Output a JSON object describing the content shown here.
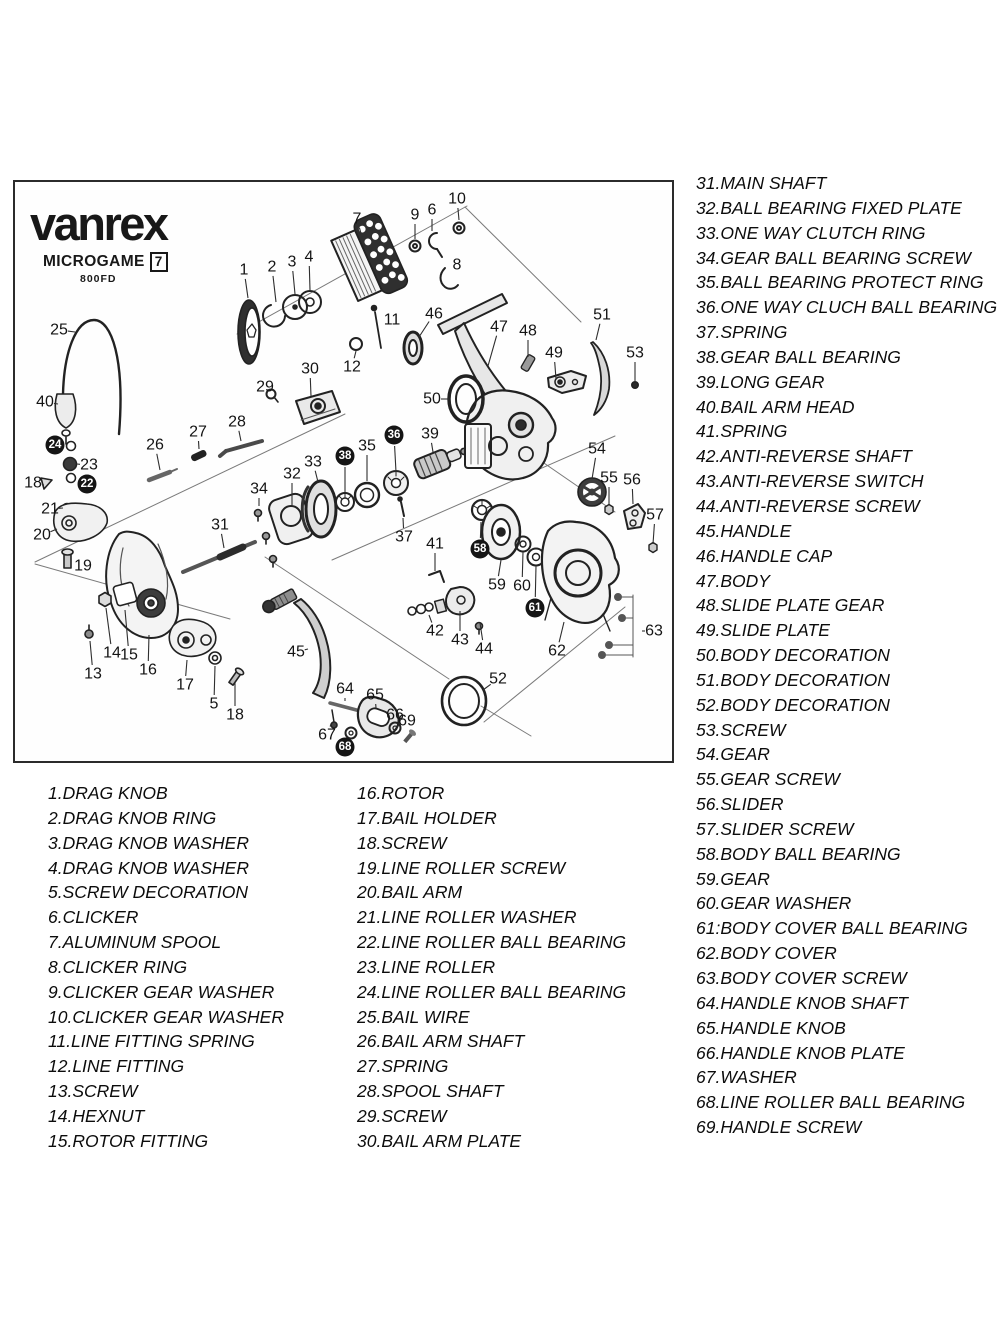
{
  "brand": {
    "logo": "vanrex",
    "series": "MICROGAME",
    "series_code": "7",
    "model": "800FD"
  },
  "parts_list_left": [
    "1.DRAG KNOB",
    "2.DRAG KNOB RING",
    "3.DRAG KNOB WASHER",
    "4.DRAG KNOB WASHER",
    "5.SCREW DECORATION",
    "6.CLICKER",
    "7.ALUMINUM SPOOL",
    "8.CLICKER RING",
    "9.CLICKER GEAR WASHER",
    "10.CLICKER GEAR WASHER",
    "11.LINE FITTING SPRING",
    "12.LINE FITTING",
    "13.SCREW",
    "14.HEXNUT",
    "15.ROTOR FITTING"
  ],
  "parts_list_middle": [
    "16.ROTOR",
    "17.BAIL HOLDER",
    "18.SCREW",
    "19.LINE ROLLER SCREW",
    "20.BAIL ARM",
    "21.LINE ROLLER WASHER",
    "22.LINE ROLLER BALL BEARING",
    "23.LINE ROLLER",
    "24.LINE ROLLER BALL BEARING",
    "25.BAIL WIRE",
    "26.BAIL ARM SHAFT",
    "27.SPRING",
    "28.SPOOL SHAFT",
    "29.SCREW",
    "30.BAIL ARM PLATE"
  ],
  "parts_list_right": [
    "31.MAIN SHAFT",
    "32.BALL BEARING FIXED PLATE",
    "33.ONE WAY CLUTCH RING",
    "34.GEAR BALL BEARING SCREW",
    "35.BALL BEARING PROTECT RING",
    "36.ONE WAY CLUCH BALL BEARING",
    "37.SPRING",
    "38.GEAR BALL BEARING",
    "39.LONG GEAR",
    "40.BAIL ARM HEAD",
    "41.SPRING",
    "42.ANTI-REVERSE SHAFT",
    "43.ANTI-REVERSE SWITCH",
    "44.ANTI-REVERSE SCREW",
    "45.HANDLE",
    "46.HANDLE CAP",
    "47.BODY",
    "48.SLIDE PLATE GEAR",
    "49.SLIDE PLATE",
    "50.BODY DECORATION",
    "51.BODY DECORATION",
    "52.BODY DECORATION",
    "53.SCREW",
    "54.GEAR",
    "55.GEAR SCREW",
    "56.SLIDER",
    "57.SLIDER SCREW",
    "58.BODY BALL BEARING",
    "59.GEAR",
    "60.GEAR WASHER",
    "61:BODY COVER BALL BEARING",
    "62.BODY COVER",
    "63.BODY COVER SCREW",
    "64.HANDLE KNOB SHAFT",
    "65.HANDLE KNOB",
    "66.HANDLE KNOB PLATE",
    "67.WASHER",
    "68.LINE ROLLER BALL BEARING",
    "69.HANDLE SCREW"
  ],
  "diagram": {
    "callouts": [
      {
        "n": "1",
        "x": 229,
        "y": 88,
        "tx": 233,
        "ty": 116,
        "c": false
      },
      {
        "n": "2",
        "x": 257,
        "y": 85,
        "tx": 261,
        "ty": 120,
        "c": false
      },
      {
        "n": "3",
        "x": 277,
        "y": 80,
        "tx": 280,
        "ty": 112,
        "c": false
      },
      {
        "n": "4",
        "x": 294,
        "y": 75,
        "tx": 295,
        "ty": 108,
        "c": false
      },
      {
        "n": "5",
        "x": 199,
        "y": 522,
        "tx": 200,
        "ty": 484,
        "c": false
      },
      {
        "n": "6",
        "x": 417,
        "y": 28,
        "tx": 417,
        "ty": 49,
        "c": false
      },
      {
        "n": "7",
        "x": 342,
        "y": 37,
        "tx": 347,
        "ty": 55,
        "c": false
      },
      {
        "n": "8",
        "x": 442,
        "y": 83,
        "tx": 434,
        "ty": 90,
        "c": false
      },
      {
        "n": "9",
        "x": 400,
        "y": 33,
        "tx": 400,
        "ty": 57,
        "c": false
      },
      {
        "n": "10",
        "x": 442,
        "y": 17,
        "tx": 444,
        "ty": 38,
        "c": false
      },
      {
        "n": "11",
        "x": 377,
        "y": 138,
        "tx": 368,
        "ty": 142,
        "c": false
      },
      {
        "n": "12",
        "x": 337,
        "y": 185,
        "tx": 341,
        "ty": 169,
        "c": false
      },
      {
        "n": "13",
        "x": 78,
        "y": 492,
        "tx": 75,
        "ty": 459,
        "c": false
      },
      {
        "n": "14",
        "x": 97,
        "y": 471,
        "tx": 91,
        "ty": 426,
        "c": false
      },
      {
        "n": "15",
        "x": 114,
        "y": 473,
        "tx": 110,
        "ty": 428,
        "c": false
      },
      {
        "n": "16",
        "x": 133,
        "y": 488,
        "tx": 134,
        "ty": 453,
        "c": false
      },
      {
        "n": "17",
        "x": 170,
        "y": 503,
        "tx": 172,
        "ty": 478,
        "c": false
      },
      {
        "n": "18",
        "x": 18,
        "y": 301,
        "tx": 29,
        "ty": 303,
        "c": false
      },
      {
        "n": "19",
        "x": 68,
        "y": 384,
        "tx": 59,
        "ty": 380,
        "c": false
      },
      {
        "n": "20",
        "x": 27,
        "y": 353,
        "tx": 42,
        "ty": 347,
        "c": false
      },
      {
        "n": "21",
        "x": 35,
        "y": 327,
        "tx": 48,
        "ty": 326,
        "c": false
      },
      {
        "n": "22",
        "x": 72,
        "y": 302,
        "tx": 63,
        "ty": 296,
        "c": true
      },
      {
        "n": "23",
        "x": 74,
        "y": 283,
        "tx": 62,
        "ty": 282,
        "c": false
      },
      {
        "n": "24",
        "x": 40,
        "y": 263,
        "tx": 52,
        "ty": 265,
        "c": true
      },
      {
        "n": "25",
        "x": 44,
        "y": 148,
        "tx": 60,
        "ty": 150,
        "c": false
      },
      {
        "n": "26",
        "x": 140,
        "y": 263,
        "tx": 145,
        "ty": 288,
        "c": false
      },
      {
        "n": "27",
        "x": 183,
        "y": 250,
        "tx": 184,
        "ty": 267,
        "c": false
      },
      {
        "n": "28",
        "x": 222,
        "y": 240,
        "tx": 226,
        "ty": 259,
        "c": false
      },
      {
        "n": "29",
        "x": 250,
        "y": 205,
        "tx": 256,
        "ty": 211,
        "c": false
      },
      {
        "n": "30",
        "x": 295,
        "y": 187,
        "tx": 296,
        "ty": 214,
        "c": false
      },
      {
        "n": "31",
        "x": 205,
        "y": 343,
        "tx": 209,
        "ty": 366,
        "c": false
      },
      {
        "n": "32",
        "x": 277,
        "y": 292,
        "tx": 277,
        "ty": 324,
        "c": false
      },
      {
        "n": "33",
        "x": 298,
        "y": 280,
        "tx": 303,
        "ty": 300,
        "c": false
      },
      {
        "n": "34",
        "x": 244,
        "y": 307,
        "tx": 244,
        "ty": 324,
        "c": false
      },
      {
        "n": "35",
        "x": 352,
        "y": 264,
        "tx": 352,
        "ty": 299,
        "c": false
      },
      {
        "n": "36",
        "x": 379,
        "y": 253,
        "tx": 381,
        "ty": 290,
        "c": true
      },
      {
        "n": "37",
        "x": 389,
        "y": 355,
        "tx": 388,
        "ty": 336,
        "c": false
      },
      {
        "n": "38",
        "x": 330,
        "y": 274,
        "tx": 330,
        "ty": 310,
        "c": true
      },
      {
        "n": "39",
        "x": 415,
        "y": 252,
        "tx": 418,
        "ty": 270,
        "c": false
      },
      {
        "n": "40",
        "x": 30,
        "y": 220,
        "tx": 43,
        "ty": 222,
        "c": false
      },
      {
        "n": "41",
        "x": 420,
        "y": 362,
        "tx": 420,
        "ty": 389,
        "c": false
      },
      {
        "n": "42",
        "x": 420,
        "y": 449,
        "tx": 414,
        "ty": 433,
        "c": false
      },
      {
        "n": "43",
        "x": 445,
        "y": 458,
        "tx": 445,
        "ty": 429,
        "c": false
      },
      {
        "n": "44",
        "x": 469,
        "y": 467,
        "tx": 465,
        "ty": 441,
        "c": false
      },
      {
        "n": "45",
        "x": 281,
        "y": 470,
        "tx": 293,
        "ty": 467,
        "c": false
      },
      {
        "n": "46",
        "x": 419,
        "y": 132,
        "tx": 404,
        "ty": 155,
        "c": false
      },
      {
        "n": "47",
        "x": 484,
        "y": 145,
        "tx": 473,
        "ty": 184,
        "c": false
      },
      {
        "n": "48",
        "x": 513,
        "y": 149,
        "tx": 513,
        "ty": 175,
        "c": false
      },
      {
        "n": "49",
        "x": 539,
        "y": 171,
        "tx": 541,
        "ty": 197,
        "c": false
      },
      {
        "n": "50",
        "x": 417,
        "y": 217,
        "tx": 434,
        "ty": 217,
        "c": false
      },
      {
        "n": "51",
        "x": 587,
        "y": 133,
        "tx": 581,
        "ty": 158,
        "c": false
      },
      {
        "n": "52",
        "x": 483,
        "y": 497,
        "tx": 468,
        "ty": 508,
        "c": false
      },
      {
        "n": "53",
        "x": 620,
        "y": 171,
        "tx": 620,
        "ty": 199,
        "c": false
      },
      {
        "n": "54",
        "x": 582,
        "y": 267,
        "tx": 577,
        "ty": 297,
        "c": false
      },
      {
        "n": "55",
        "x": 594,
        "y": 296,
        "tx": 594,
        "ty": 322,
        "c": false
      },
      {
        "n": "56",
        "x": 617,
        "y": 298,
        "tx": 618,
        "ty": 322,
        "c": false
      },
      {
        "n": "57",
        "x": 640,
        "y": 333,
        "tx": 638,
        "ty": 362,
        "c": false
      },
      {
        "n": "58",
        "x": 465,
        "y": 367,
        "tx": 466,
        "ty": 340,
        "c": true
      },
      {
        "n": "59",
        "x": 482,
        "y": 403,
        "tx": 486,
        "ty": 378,
        "c": false
      },
      {
        "n": "60",
        "x": 507,
        "y": 404,
        "tx": 508,
        "ty": 370,
        "c": false
      },
      {
        "n": "61",
        "x": 520,
        "y": 426,
        "tx": 521,
        "ty": 384,
        "c": true
      },
      {
        "n": "62",
        "x": 542,
        "y": 469,
        "tx": 549,
        "ty": 440,
        "c": false
      },
      {
        "n": "63",
        "x": 639,
        "y": 449,
        "tx": 627,
        "ty": 449,
        "c": false
      },
      {
        "n": "64",
        "x": 330,
        "y": 507,
        "tx": 330,
        "ty": 519,
        "c": false
      },
      {
        "n": "65",
        "x": 360,
        "y": 513,
        "tx": 361,
        "ty": 526,
        "c": false
      },
      {
        "n": "66",
        "x": 380,
        "y": 533,
        "tx": 380,
        "ty": 542,
        "c": false
      },
      {
        "n": "67",
        "x": 312,
        "y": 553,
        "tx": 316,
        "ty": 542,
        "c": false
      },
      {
        "n": "68",
        "x": 330,
        "y": 565,
        "tx": 334,
        "ty": 556,
        "c": true
      },
      {
        "n": "69",
        "x": 392,
        "y": 539,
        "tx": 393,
        "ty": 549,
        "c": false
      },
      {
        "n": "18",
        "x": 220,
        "y": 533,
        "tx": 220,
        "ty": 500,
        "c": false
      }
    ]
  }
}
